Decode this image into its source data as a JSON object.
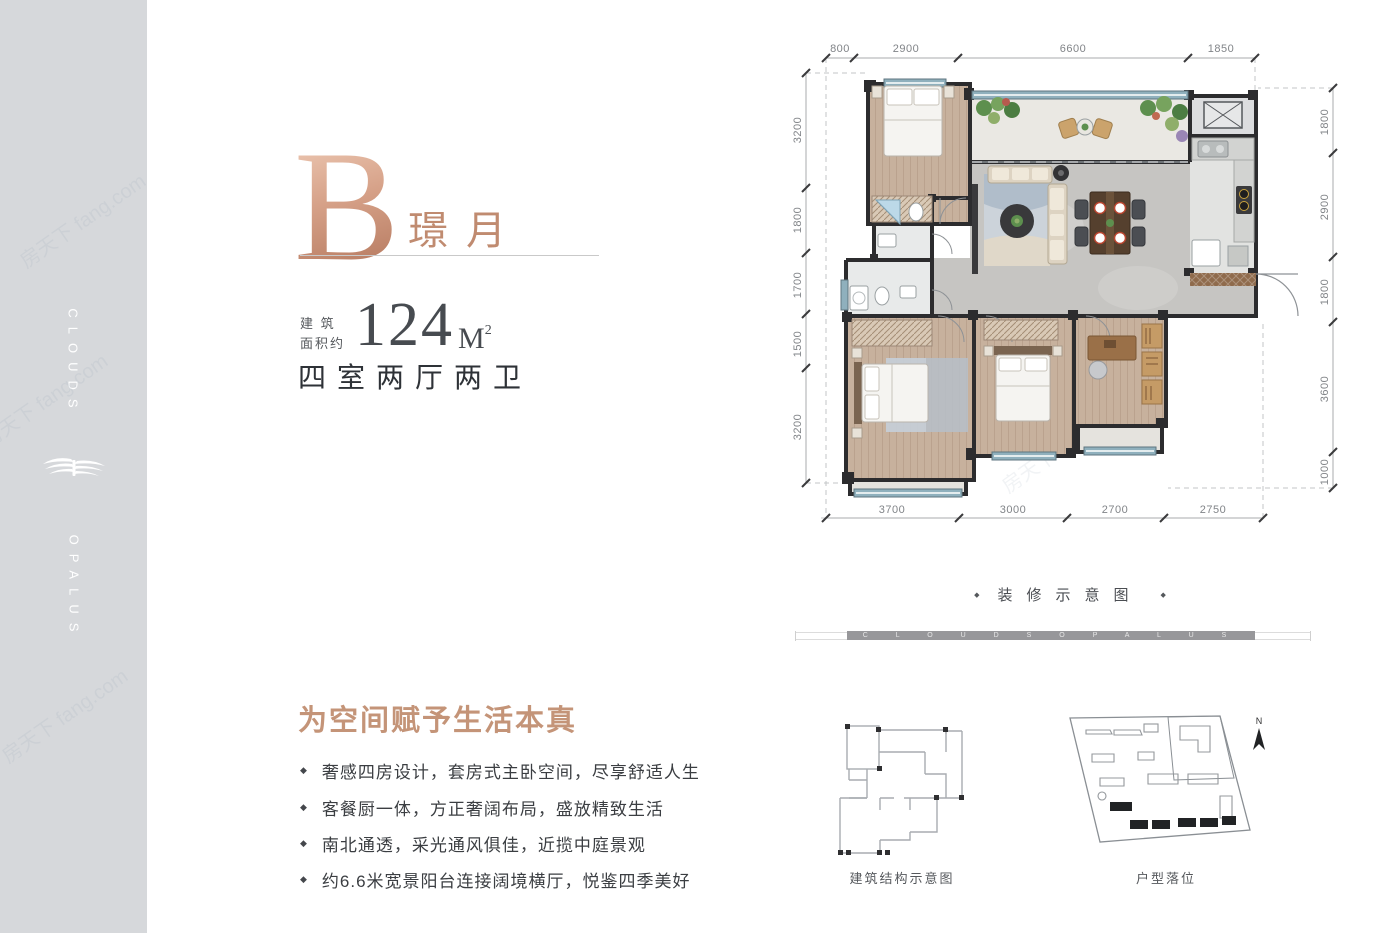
{
  "sidebar": {
    "top_text": "CLOUDS",
    "bottom_text": "OPALUS"
  },
  "watermark": {
    "text": "房天下 fang.com"
  },
  "header": {
    "unit_letter": "B",
    "unit_name": "璟月",
    "area_prefix_line1": "建 筑",
    "area_prefix_line2": "面积约",
    "area_value": "124",
    "area_unit": "M",
    "area_sup": "2",
    "layout_text": "四室两厅两卫"
  },
  "features": {
    "heading": "为空间赋予生活本真",
    "bullet": "◆",
    "items": [
      "奢感四房设计，套房式主卧空间，尽享舒适人生",
      "客餐厨一体，方正奢阔布局，盛放精致生活",
      "南北通透，采光通风俱佳，近揽中庭景观",
      "约6.6米宽景阳台连接阔境横厅，悦鉴四季美好"
    ]
  },
  "floorplan": {
    "caption": "装修示意图",
    "caption_diamond": "◆",
    "brand_bar_text": "C L O U D S O P A L U S",
    "dims_top": [
      "800",
      "2900",
      "6600",
      "1850"
    ],
    "dims_left": [
      "3200",
      "1800",
      "1700",
      "1500",
      "3200"
    ],
    "dims_right": [
      "1800",
      "2900",
      "1800",
      "3600",
      "1000"
    ],
    "dims_bottom": [
      "3700",
      "3000",
      "2700",
      "2750"
    ]
  },
  "diagrams": {
    "structure_label": "建筑结构示意图",
    "location_label": "户型落位",
    "compass_label": "N"
  },
  "colors": {
    "accent_rose": "#c49478",
    "sidebar_gray": "#d6d8db",
    "wall_dark": "#2c2c2e",
    "window_teal": "#8fb0bd"
  }
}
